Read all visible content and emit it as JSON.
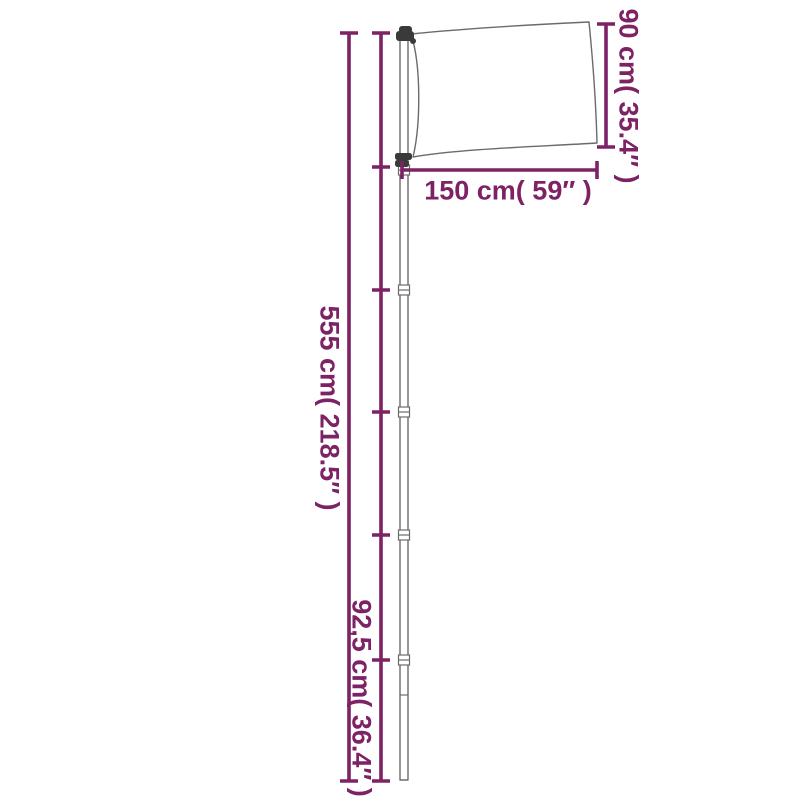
{
  "diagram": {
    "kind": "product-dimension-diagram",
    "colors": {
      "dimension_lines": "#7C2265",
      "outline": "#6B6B6B",
      "hardware": "#3A3A3A",
      "background": "#FFFFFF"
    },
    "labels": {
      "total_height": "555 cm( 218.5″ )",
      "segment_length": "92,5 cm( 36.4″ )",
      "flag_height": "90 cm( 35.4″ )",
      "flag_width": "150 cm( 59″ )"
    },
    "measurements": {
      "total_height_cm": "555",
      "total_height_in": "218.5",
      "segment_length_cm": "92,5",
      "segment_length_in": "36.4",
      "flag_height_cm": "90",
      "flag_height_in": "35.4",
      "flag_width_cm": "150",
      "flag_width_in": "59"
    }
  }
}
